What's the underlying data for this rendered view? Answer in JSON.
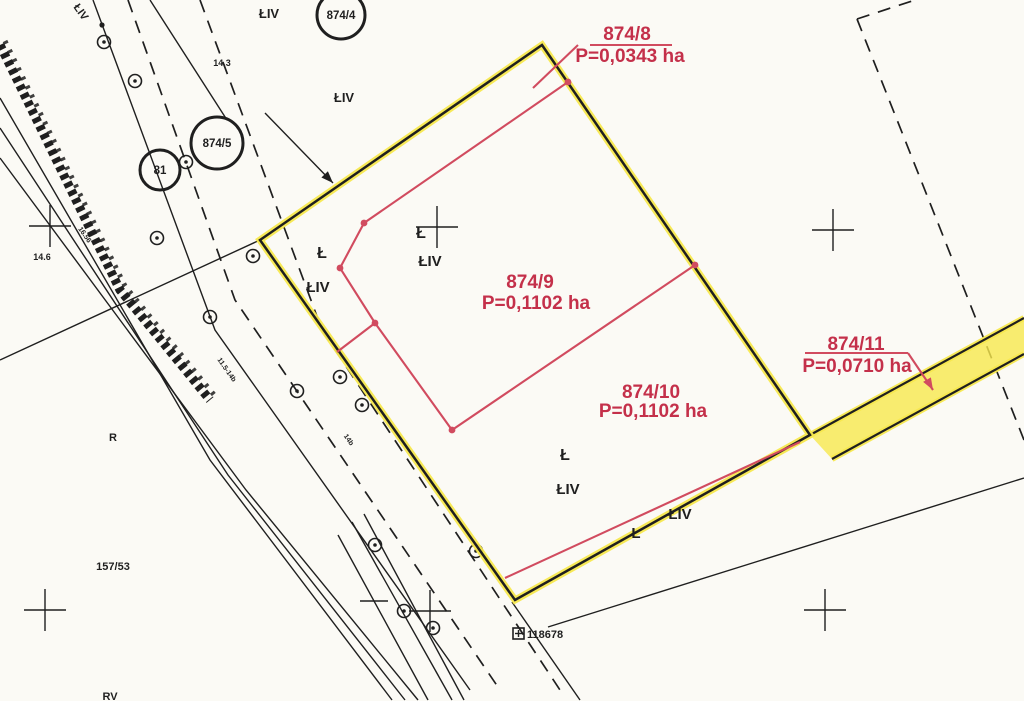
{
  "map": {
    "type": "cadastral-parcel-map",
    "colors": {
      "paper": "#fbfaf5",
      "ink_black": "#1f1f1f",
      "boundary_yellow": "#f7e84e",
      "red_line": "#d14b5f",
      "red_text": "#c4304a"
    },
    "parcel_labels": [
      {
        "name": "874-8",
        "number": "874/8",
        "area": "P=0,0343 ha",
        "nx": 627,
        "ny": 40,
        "ax": 630,
        "ay": 62,
        "underline": "590,45 672,45"
      },
      {
        "name": "874-9",
        "number": "874/9",
        "area": "P=0,1102 ha",
        "nx": 530,
        "ny": 288,
        "ax": 536,
        "ay": 309
      },
      {
        "name": "874-10",
        "number": "874/10",
        "area": "P=0,1102 ha",
        "nx": 651,
        "ny": 398,
        "ax": 653,
        "ay": 417
      },
      {
        "name": "874-11",
        "number": "874/11",
        "area": "P=0,0710 ha",
        "nx": 856,
        "ny": 350,
        "ax": 857,
        "ay": 372,
        "underline": "805,353 908,353"
      }
    ],
    "circled_labels": [
      {
        "name": "parcel-circle-874-4",
        "text": "874/4",
        "cx": 341,
        "cy": 15,
        "r": 24
      },
      {
        "name": "parcel-circle-874-5",
        "text": "874/5",
        "cx": 217,
        "cy": 143,
        "r": 26
      },
      {
        "name": "parcel-circle-81",
        "text": "81",
        "cx": 160,
        "cy": 170,
        "r": 20
      }
    ],
    "land_use_labels": [
      {
        "name": "landuse-liv-top",
        "text": "ŁIV",
        "x": 269,
        "y": 18,
        "size": 13,
        "rot": 0
      },
      {
        "name": "dim-14-3",
        "text": "14.3",
        "x": 222,
        "y": 66,
        "size": 9,
        "rot": 0
      },
      {
        "name": "landuse-liv-upper",
        "text": "ŁIV",
        "x": 344,
        "y": 102,
        "size": 13,
        "rot": 0
      },
      {
        "name": "landuse-l-left",
        "text": "Ł",
        "x": 322,
        "y": 258,
        "size": 16,
        "rot": 0
      },
      {
        "name": "landuse-liv-left",
        "text": "ŁIV",
        "x": 318,
        "y": 292,
        "size": 15,
        "rot": 0
      },
      {
        "name": "landuse-l-cross",
        "text": "Ł",
        "x": 421,
        "y": 238,
        "size": 16,
        "rot": 0
      },
      {
        "name": "landuse-liv-center",
        "text": "ŁIV",
        "x": 430,
        "y": 266,
        "size": 15,
        "rot": 0
      },
      {
        "name": "landuse-l-bottom",
        "text": "Ł",
        "x": 565,
        "y": 460,
        "size": 16,
        "rot": 0
      },
      {
        "name": "landuse-liv-bottom",
        "text": "ŁIV",
        "x": 568,
        "y": 494,
        "size": 15,
        "rot": 0
      },
      {
        "name": "landuse-liv-road",
        "text": "ŁIV",
        "x": 680,
        "y": 519,
        "size": 15,
        "rot": 0
      },
      {
        "name": "landuse-l-road",
        "text": "Ł",
        "x": 636,
        "y": 538,
        "size": 15,
        "rot": 0
      },
      {
        "name": "landuse-r",
        "text": "R",
        "x": 113,
        "y": 441,
        "size": 11,
        "rot": 0
      },
      {
        "name": "parcel-157-53",
        "text": "157/53",
        "x": 113,
        "y": 570,
        "size": 11,
        "rot": 0
      },
      {
        "name": "landuse-rv",
        "text": "RV",
        "x": 110,
        "y": 700,
        "size": 11,
        "rot": 0
      },
      {
        "name": "dim-14-6",
        "text": "14.6",
        "x": 42,
        "y": 260,
        "size": 9,
        "rot": 0
      },
      {
        "name": "landuse-liv-rotated",
        "text": "ŁIV",
        "x": 78,
        "y": 14,
        "size": 11,
        "rot": 55
      },
      {
        "name": "dim-16-56",
        "text": "16.56",
        "x": 83,
        "y": 236,
        "size": 7,
        "rot": 55
      },
      {
        "name": "dim-road",
        "text": "11.5-14b",
        "x": 225,
        "y": 371,
        "size": 7,
        "rot": 55
      },
      {
        "name": "dim-14b",
        "text": "14b",
        "x": 347,
        "y": 441,
        "size": 7,
        "rot": 55
      }
    ],
    "survey_marker": {
      "text": "118678",
      "bx": 513,
      "by": 628,
      "bs": 11,
      "tx": 527,
      "ty": 638
    },
    "geometry": {
      "boundary_polygon": "542,45 810,435 515,600 260,240",
      "strip_polygon": "810,435 1024,318 1024,354 832,459",
      "strip_edges": [
        "810,435 1024,318",
        "832,459 1024,354"
      ],
      "red_lines": [
        "568,82 364,223 340,268 375,323 452,430 695,265",
        "375,323 337,352",
        "505,578 800,442",
        "533,88 578,45",
        "908,353 933,390"
      ],
      "red_dots": [
        [
          568,
          82
        ],
        [
          364,
          223
        ],
        [
          340,
          268
        ],
        [
          375,
          323
        ],
        [
          452,
          430
        ],
        [
          695,
          265
        ]
      ],
      "solid_lines": [
        "0,98 210,460 392,700",
        "0,128 228,475 405,700",
        "0,158 246,490 418,700",
        "93,0 215,330 470,690",
        "352,522 452,700",
        "364,514 464,700",
        "338,535 428,700",
        "360,601 388,601",
        "512,602 580,700",
        "548,627 1024,478",
        "260,240 0,360",
        "150,0 227,120",
        "265,113 333,183"
      ],
      "dashed_lines": [
        "128,0 235,300 500,690",
        "200,0 322,330 560,690",
        "857,19 915,0",
        "857,19 1024,440"
      ],
      "hatch_band": "0,45 120,290 210,400",
      "crosses": [
        [
          50,
          226
        ],
        [
          437,
          227
        ],
        [
          833,
          230
        ],
        [
          45,
          610
        ],
        [
          430,
          611
        ],
        [
          825,
          610
        ]
      ],
      "trees": [
        [
          104,
          42
        ],
        [
          135,
          81
        ],
        [
          186,
          162
        ],
        [
          157,
          238
        ],
        [
          253,
          256
        ],
        [
          210,
          317
        ],
        [
          297,
          391
        ],
        [
          340,
          377
        ],
        [
          362,
          405
        ],
        [
          375,
          545
        ],
        [
          476,
          551
        ],
        [
          404,
          611
        ],
        [
          433,
          628
        ]
      ],
      "point_dots": [
        [
          102,
          25
        ]
      ],
      "arrowheads": [
        {
          "x": 333,
          "y": 183,
          "angle": 46,
          "color": "black",
          "name": "leader-arrowhead-874-5"
        },
        {
          "x": 933,
          "y": 390,
          "angle": 60,
          "color": "red",
          "name": "leader-arrowhead-874-11"
        }
      ]
    }
  }
}
